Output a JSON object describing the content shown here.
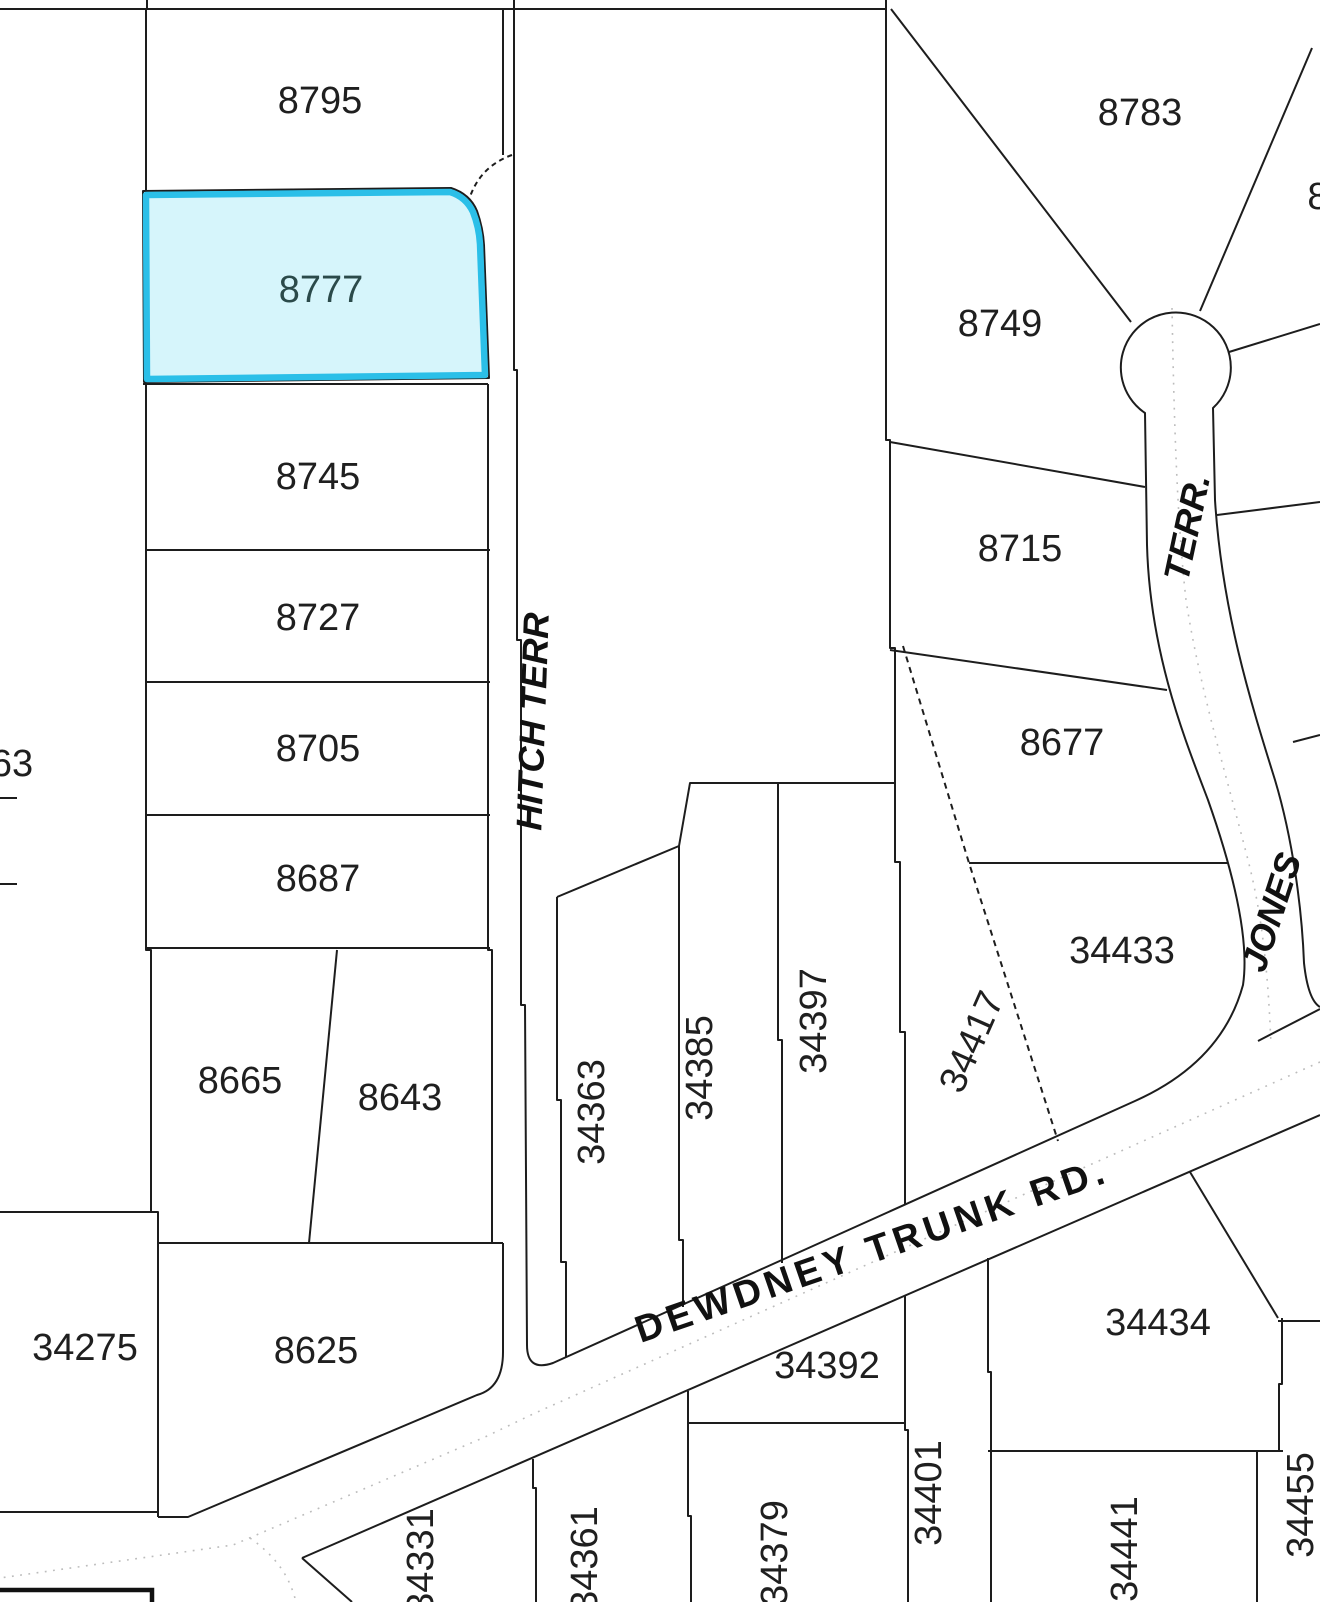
{
  "map": {
    "type": "cadastral-parcel-map",
    "selected_lot": "8777",
    "background_color": "#ffffff",
    "boundary_line_color": "#1d1d1d",
    "highlight_stroke_color": "#2bbfe8",
    "highlight_fill_color": "#d6f5fb",
    "selected_label_color": "#2b4a4a",
    "centerline_color": "#bcbcbc"
  },
  "lot_labels": [
    {
      "text": "8795"
    },
    {
      "text": "8777"
    },
    {
      "text": "8745"
    },
    {
      "text": "8727"
    },
    {
      "text": "8705"
    },
    {
      "text": "8687"
    },
    {
      "text": "8665"
    },
    {
      "text": "8643"
    },
    {
      "text": "8625"
    },
    {
      "text": "34275"
    },
    {
      "text": "63"
    },
    {
      "text": "8783"
    },
    {
      "text": "8749"
    },
    {
      "text": "8715"
    },
    {
      "text": "8677"
    },
    {
      "text": "34433"
    },
    {
      "text": "34434"
    },
    {
      "text": "34392"
    },
    {
      "text": "8"
    },
    {
      "text": "34363"
    },
    {
      "text": "34385"
    },
    {
      "text": "34397"
    },
    {
      "text": "34417"
    },
    {
      "text": "34401"
    },
    {
      "text": "34379"
    },
    {
      "text": "34361"
    },
    {
      "text": "34331"
    },
    {
      "text": "34441"
    },
    {
      "text": "34455"
    }
  ],
  "street_labels": [
    {
      "text": "HITCH TERR"
    },
    {
      "text": "TERR."
    },
    {
      "text": "JONES"
    },
    {
      "text": "DEWDNEY TRUNK RD."
    }
  ]
}
